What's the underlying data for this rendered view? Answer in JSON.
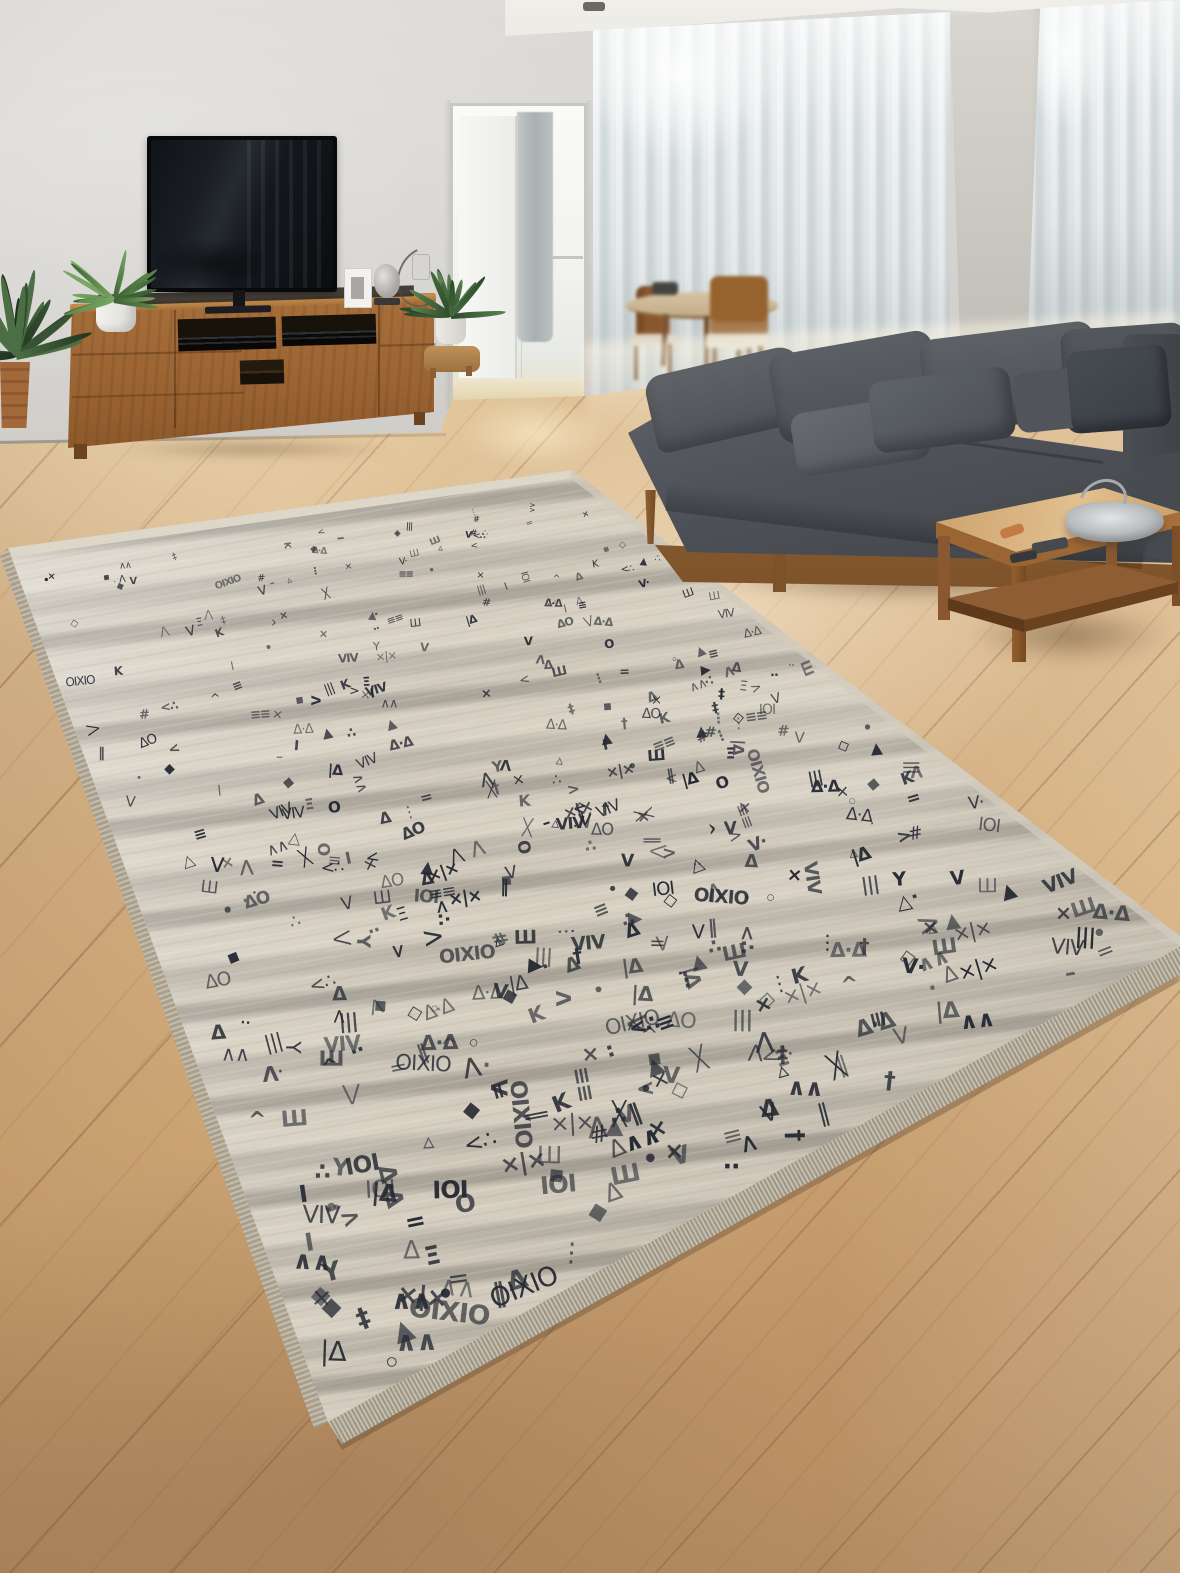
{
  "scene": {
    "type": "interior-product-photo",
    "subject": "ethnic-pattern area rug in a modern living room",
    "visible_text": "none",
    "objects": [
      "wall",
      "ceiling",
      "ceiling-lamp",
      "balcony-doorway",
      "sheer-curtains",
      "wall-pillar",
      "dining-table",
      "dining-chairs",
      "tv",
      "tv-console",
      "av-equipment",
      "potted-plants",
      "photo-frame",
      "sculpture",
      "power-outlet",
      "wood-floor",
      "area-rug",
      "rug-fringe",
      "sectional-sofa",
      "sofa-pillows",
      "coffee-table",
      "remote-controls",
      "decor-bowl"
    ]
  },
  "palette": {
    "wall": "#d6d4d0",
    "wall_light": "#dedcd8",
    "ceiling": "#ebe9e4",
    "curtain_a": "#eef1f2",
    "curtain_b": "#ccd4d6",
    "pillar": "#cdcbc4",
    "floor_a": "#e2c79c",
    "floor_b": "#cfa877",
    "floor_c": "#b28a5e",
    "sofa_a": "#5d6165",
    "sofa_b": "#44484d",
    "base_wood": "#8a5a33",
    "console_a": "#a8703c",
    "console_b": "#8a5628",
    "table_a": "#d2aa74",
    "table_b": "#9a6433",
    "tv": "#08090b",
    "rug_cream": "#d6cfc1",
    "rug_mid": "#c4bdb0",
    "rug_gray": "#a7a196",
    "rug_symbol": "#262a33",
    "fringe_a": "#c6bead",
    "fringe_b": "#9d9585"
  },
  "rug": {
    "quad": [
      [
        8,
        548
      ],
      [
        572,
        470
      ],
      [
        1188,
        942
      ],
      [
        328,
        1422
      ]
    ],
    "glyphs": [
      "▲",
      "△",
      "▲",
      "▵",
      "×",
      "╳",
      "×",
      "Δ",
      "Δ",
      "≡",
      "Λ",
      "V",
      "V",
      "Y",
      "K",
      "O",
      "I",
      "#",
      "Ш",
      "Ξ",
      "‖",
      "|||",
      "∴",
      "•",
      "◦",
      "·",
      "··",
      "<",
      ">",
      "^",
      "⋮",
      "–",
      "▪",
      "◆",
      "◇",
      "×|×",
      "ΔO",
      "OIXIO",
      "VIV",
      "≡≡",
      "∧∧",
      "IOI",
      "=",
      "†",
      "‡",
      "Δ·Δ",
      "|Δ",
      "<∴",
      "V·",
      "⋀",
      "⋁"
    ],
    "symbol_count": 520,
    "base_glyph_px": 20,
    "rows": 24,
    "seed": 9
  },
  "plants": [
    {
      "name": "floor-plant-left",
      "x": 16,
      "y": 356,
      "count": 16,
      "min_len": 45,
      "max_len": 95,
      "width": 8,
      "base_angle": -95,
      "spread": 175,
      "colors": [
        "#1f3421",
        "#375334",
        "#4c6e44"
      ],
      "seed": 3
    },
    {
      "name": "console-plant",
      "x": 114,
      "y": 300,
      "count": 18,
      "min_len": 34,
      "max_len": 62,
      "width": 5,
      "base_angle": -92,
      "spread": 210,
      "colors": [
        "#3c6134",
        "#5c8a4c",
        "#79a763"
      ],
      "seed": 5
    },
    {
      "name": "floor-plant-right",
      "x": 451,
      "y": 316,
      "count": 14,
      "min_len": 34,
      "max_len": 60,
      "width": 6,
      "base_angle": -95,
      "spread": 185,
      "colors": [
        "#2c4a2b",
        "#46683e",
        "#5d8350"
      ],
      "seed": 8
    }
  ]
}
